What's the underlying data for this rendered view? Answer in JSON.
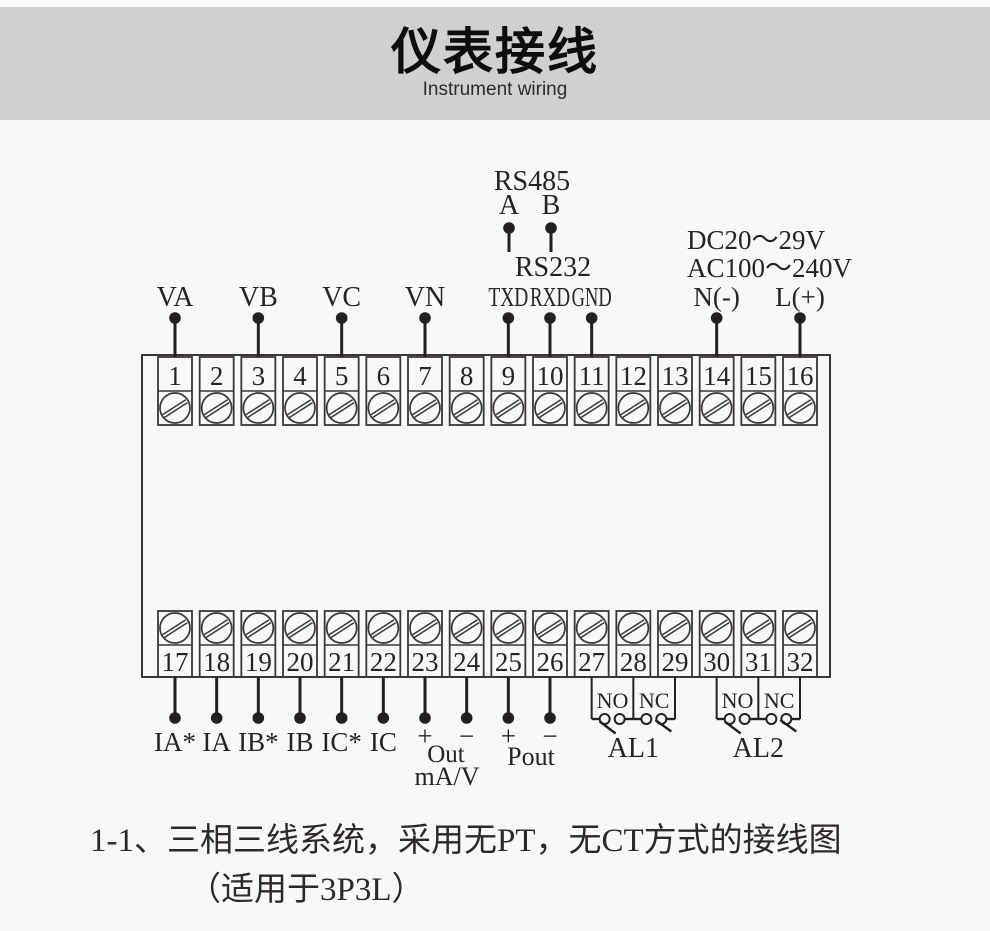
{
  "header": {
    "title": "仪表接线",
    "subtitle": "Instrument wiring"
  },
  "diagram": {
    "rs485": {
      "title": "RS485",
      "pin_a": "A",
      "pin_b": "B"
    },
    "rs232": {
      "title": "RS232"
    },
    "power": {
      "dc_range": "DC20～29V",
      "ac_range": "AC100～240V"
    },
    "analog_output": {
      "name": "Out",
      "unit": "mA/V"
    },
    "pulse_output": {
      "name": "Pout"
    },
    "terminals": {
      "top": [
        "1",
        "2",
        "3",
        "4",
        "5",
        "6",
        "7",
        "8",
        "9",
        "10",
        "11",
        "12",
        "13",
        "14",
        "15",
        "16"
      ],
      "bottom": [
        "17",
        "18",
        "19",
        "20",
        "21",
        "22",
        "23",
        "24",
        "25",
        "26",
        "27",
        "28",
        "29",
        "30",
        "31",
        "32"
      ]
    },
    "wiring_top": [
      {
        "label": "VA",
        "terminal": 1
      },
      {
        "label": "VB",
        "terminal": 3
      },
      {
        "label": "VC",
        "terminal": 5
      },
      {
        "label": "VN",
        "terminal": 7
      },
      {
        "label": "TXD",
        "terminal": 9
      },
      {
        "label": "RXD",
        "terminal": 10
      },
      {
        "label": "GND",
        "terminal": 11
      },
      {
        "label": "N(-)",
        "terminal": 14
      },
      {
        "label": "L(+)",
        "terminal": 16
      }
    ],
    "wiring_bottom": [
      {
        "label": "IA*",
        "terminal": 17
      },
      {
        "label": "IA",
        "terminal": 18
      },
      {
        "label": "IB*",
        "terminal": 19
      },
      {
        "label": "IB",
        "terminal": 20
      },
      {
        "label": "IC*",
        "terminal": 21
      },
      {
        "label": "IC",
        "terminal": 22
      },
      {
        "label": "+",
        "terminal": 23
      },
      {
        "label": "−",
        "terminal": 24
      },
      {
        "label": "+",
        "terminal": 25
      },
      {
        "label": "−",
        "terminal": 26
      }
    ],
    "relays": [
      {
        "label": "AL1",
        "contacts": [
          "NO",
          "NC"
        ],
        "terminals": [
          27,
          28,
          29
        ]
      },
      {
        "label": "AL2",
        "contacts": [
          "NO",
          "NC"
        ],
        "terminals": [
          30,
          31,
          32
        ]
      }
    ]
  },
  "caption": {
    "line1": "1-1、三相三线系统，采用无PT，无CT方式的接线图",
    "line2": "（适用于3P3L）"
  },
  "colors": {
    "header_band": "#d1d0d0",
    "background": "#f8f8f8",
    "diagram_line": "#3c3735",
    "wire": "#242020",
    "text": "#282321"
  }
}
